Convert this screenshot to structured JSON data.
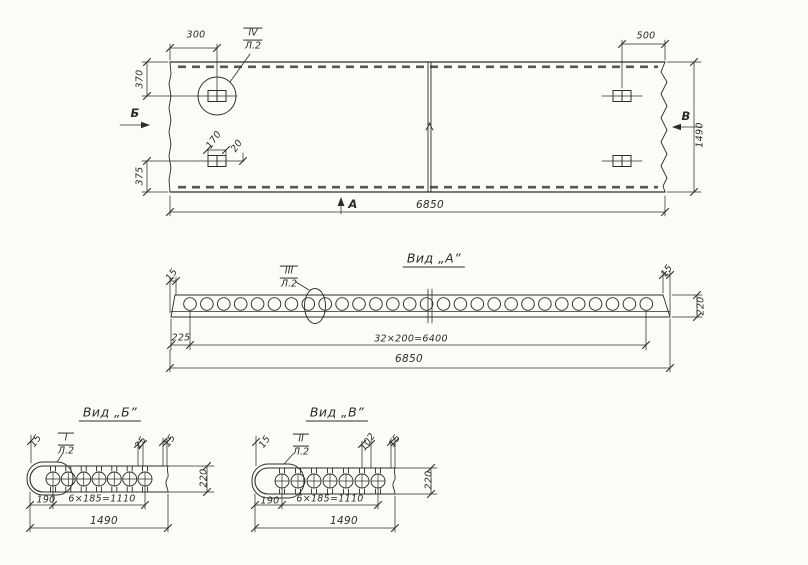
{
  "plan": {
    "d300": "300",
    "d500": "500",
    "d370": "370",
    "d375": "375",
    "d170": "170",
    "d20": "20",
    "d6850": "6850",
    "d1490": "1490",
    "sec_b": "Б",
    "sec_v": "В",
    "sec_a": "А",
    "callout_num": "IV",
    "callout_sheet": "Л.2"
  },
  "view_a": {
    "title": "Вид „А”",
    "d15l": "15",
    "d15r": "15",
    "d220": "220",
    "d225": "225",
    "d32x200": "32×200=6400",
    "d6850": "6850",
    "callout_num": "III",
    "callout_sheet": "Л.2"
  },
  "view_b": {
    "title": "Вид „Б”",
    "d15l": "15",
    "d25": "25",
    "d15r": "15",
    "d220": "220",
    "d190": "190",
    "d6x185": "6×185=1110",
    "d1490": "1490",
    "callout_num": "I",
    "callout_sheet": "Л.2"
  },
  "view_v": {
    "title": "Вид „В”",
    "d15l": "15",
    "d102": "102",
    "d15r": "15",
    "d220": "220",
    "d190": "190",
    "d6x185": "6×185=1110",
    "d1490": "1490",
    "callout_num": "II",
    "callout_sheet": "Л.2"
  }
}
